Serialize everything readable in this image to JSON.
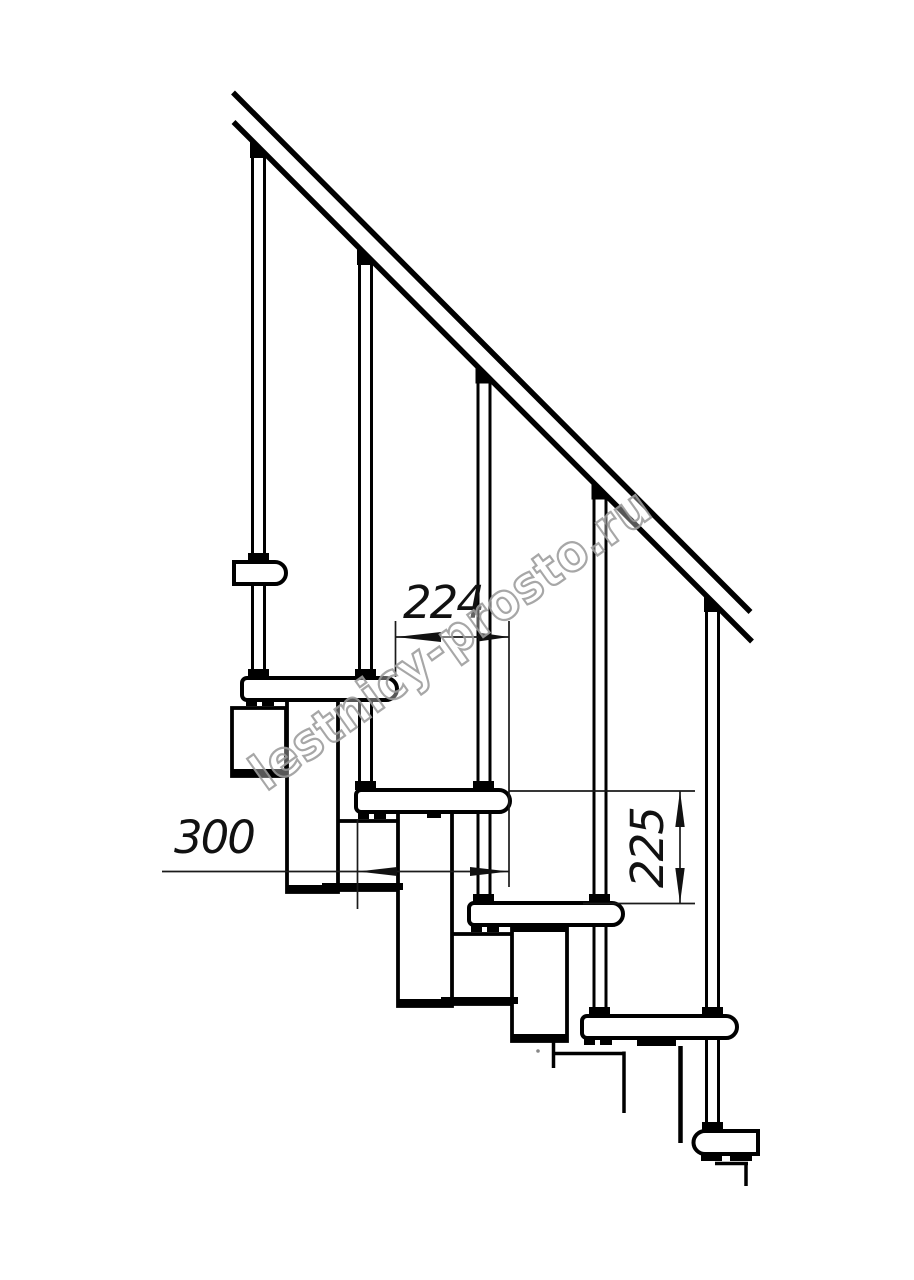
{
  "drawing": {
    "dimensions": {
      "going": "224",
      "depth": "300",
      "rise": "225"
    },
    "watermark": "lestnicy-prosto.ru",
    "colors": {
      "line": "#000000",
      "background": "#ffffff",
      "dimension": "#1a1a1a",
      "watermark_outline": "#9e9e9e"
    }
  }
}
